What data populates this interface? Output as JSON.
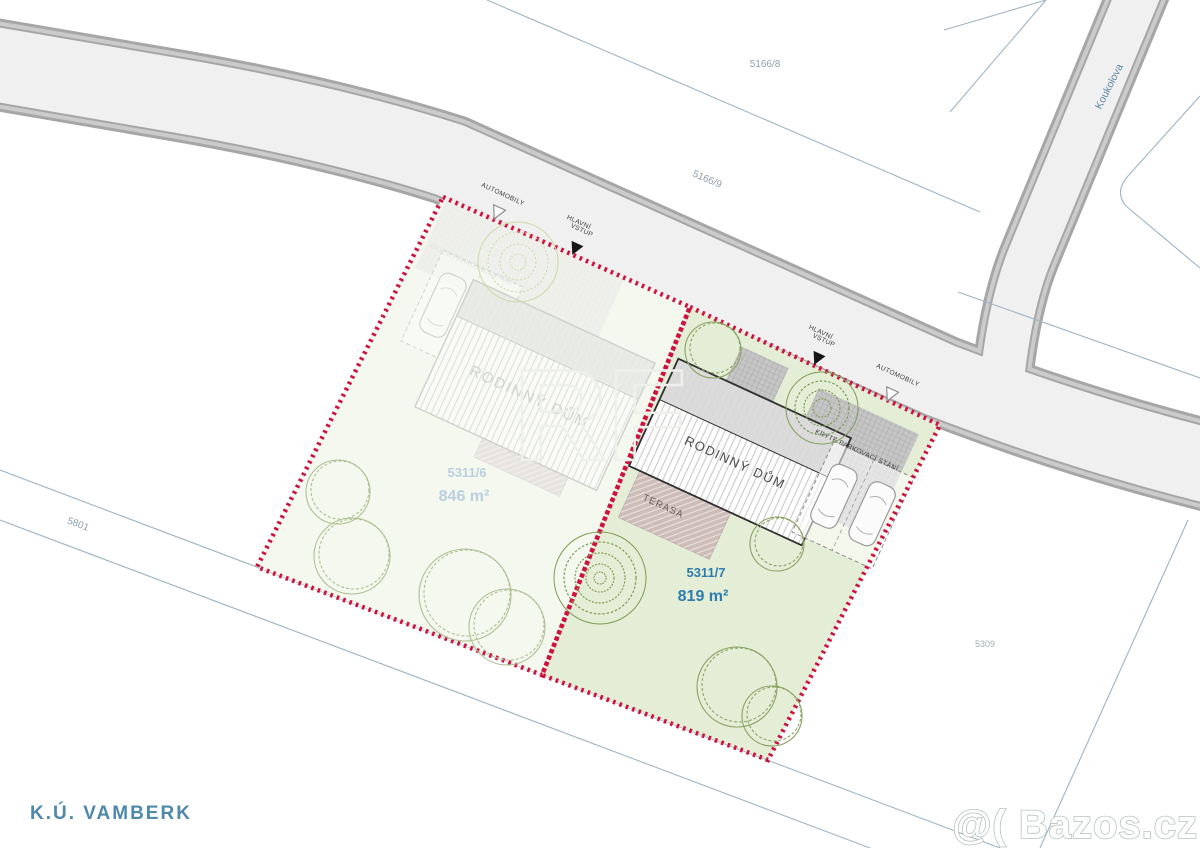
{
  "region_label": "K.Ú. VAMBERK",
  "street": {
    "name": "Koukolova"
  },
  "watermark": {
    "brand": "@( Bazos.cz",
    "ghost": "RF"
  },
  "parcels": {
    "p5166_8": {
      "number": "5166/8"
    },
    "p5166_9": {
      "number": "5166/9"
    },
    "p5801": {
      "number": "5801"
    },
    "p5309": {
      "number": "5309"
    },
    "plot_left": {
      "number": "5311/6",
      "area": "846 m²"
    },
    "plot_right": {
      "number": "5311/7",
      "area": "819 m²"
    }
  },
  "labels": {
    "house": "RODINNÝ DŮM",
    "terrace": "TERASA",
    "covered_parking": "KRYTÉ PARKOVACÍ STÁNÍ",
    "cars_entry": "AUTOMOBILY",
    "main_entry_l1": "HLAVNÍ",
    "main_entry_l2": "VSTUP"
  },
  "colors": {
    "boundary": "#ce1240",
    "plot_left_fill": "#f4f8ee",
    "plot_right_fill": "#e4eed6",
    "road_fill": "#f0f0f0",
    "curb": "#cbcbcb",
    "road_edge": "#a6a6a6",
    "cadastral_line": "#9db5c4",
    "plot_left_label": "#b9cfdf",
    "plot_right_label": "#2e7cae",
    "region_label": "#4e88aa",
    "street_label": "#5d87a3",
    "tree_outline": "#9db37c",
    "tree_dense": "#7e9b52"
  }
}
